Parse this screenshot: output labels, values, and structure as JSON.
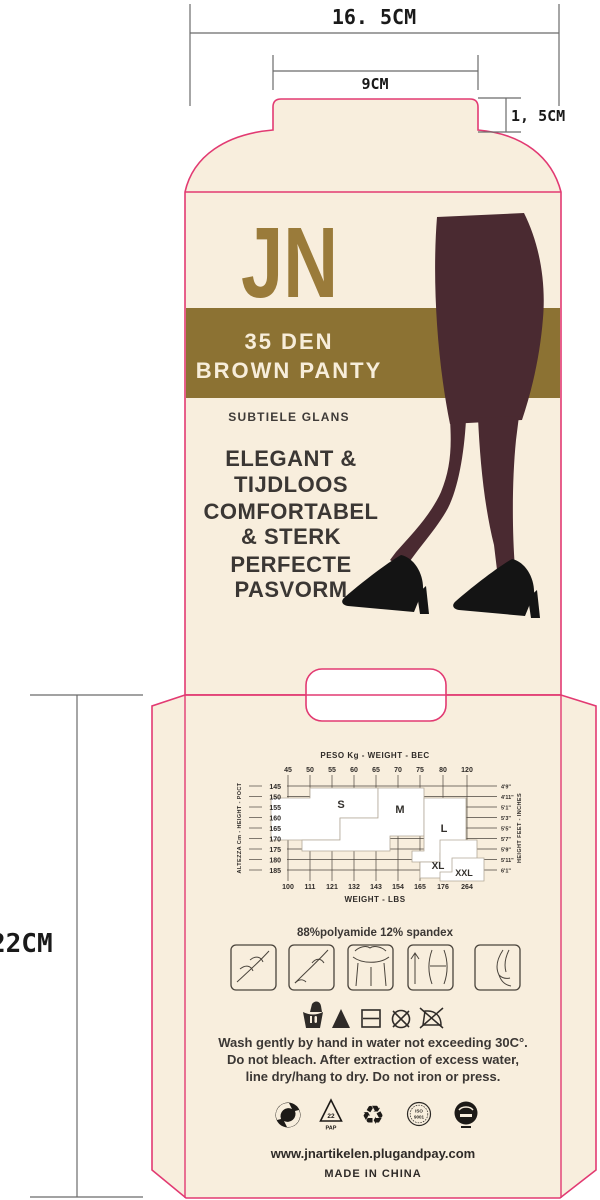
{
  "dimensions": {
    "total_width": "16. 5CM",
    "tab_width": "9CM",
    "tab_height": "1, 5CM",
    "back_height": "22CM"
  },
  "front": {
    "brand": "JN",
    "band": {
      "line1": "35 DEN",
      "line2": "BROWN PANTY"
    },
    "tagline": "SUBTIELE GLANS",
    "features": {
      "f1a": "ELEGANT &",
      "f1b": "TIJDLOOS",
      "f2a": "COMFORTABEL",
      "f2b": "& STERK",
      "f3a": "PERFECTE",
      "f3b": "PASVORM"
    }
  },
  "chart_data": {
    "type": "table",
    "title": "PESO Kg - WEIGHT - ВЕС",
    "top_axis_label": "PESO Kg - WEIGHT - ВЕС",
    "top_values": [
      "45",
      "50",
      "55",
      "60",
      "65",
      "70",
      "75",
      "80",
      "120"
    ],
    "left_axis_label": "ALTEZZA Cm - HEIGHT - РОСТ",
    "left_values": [
      "145",
      "150",
      "155",
      "160",
      "165",
      "170",
      "175",
      "180",
      "185"
    ],
    "right_axis_label": "HEIGHT FEET - INCHES",
    "right_values": [
      "4'9\"",
      "4'11\"",
      "5'1\"",
      "5'3\"",
      "5'5\"",
      "5'7\"",
      "5'9\"",
      "5'11\"",
      "6'1\""
    ],
    "bottom_axis_label": "WEIGHT - LBS",
    "bottom_values": [
      "100",
      "111",
      "121",
      "132",
      "143",
      "154",
      "165",
      "176",
      "264"
    ],
    "sizes": {
      "s": "S",
      "m": "M",
      "l": "L",
      "xl": "XL",
      "xxl": "XXL"
    }
  },
  "back": {
    "composition": "88%polyamide  12% spandex",
    "care_instructions": {
      "line1": "Wash gently by hand in water not exceeding 30C°.",
      "line2": "Do not bleach. After extraction of excess water,",
      "line3": "line dry/hang to dry.  Do not iron or press."
    },
    "eco": {
      "pap_code": "22",
      "pap_label": "PAP",
      "iso_line1": "ISO",
      "iso_line2": "9001"
    },
    "website": "www.jnartikelen.plugandpay.com",
    "origin": "MADE IN CHINA"
  },
  "colors": {
    "dieline_pink": "#e23a72",
    "cream": "#f8eedd",
    "band_olive": "#8c7233",
    "brand_gold": "#9a7b3a",
    "legs_brown": "#4a2a31",
    "shoe_black": "#141414",
    "text_dark": "#3b3734"
  }
}
